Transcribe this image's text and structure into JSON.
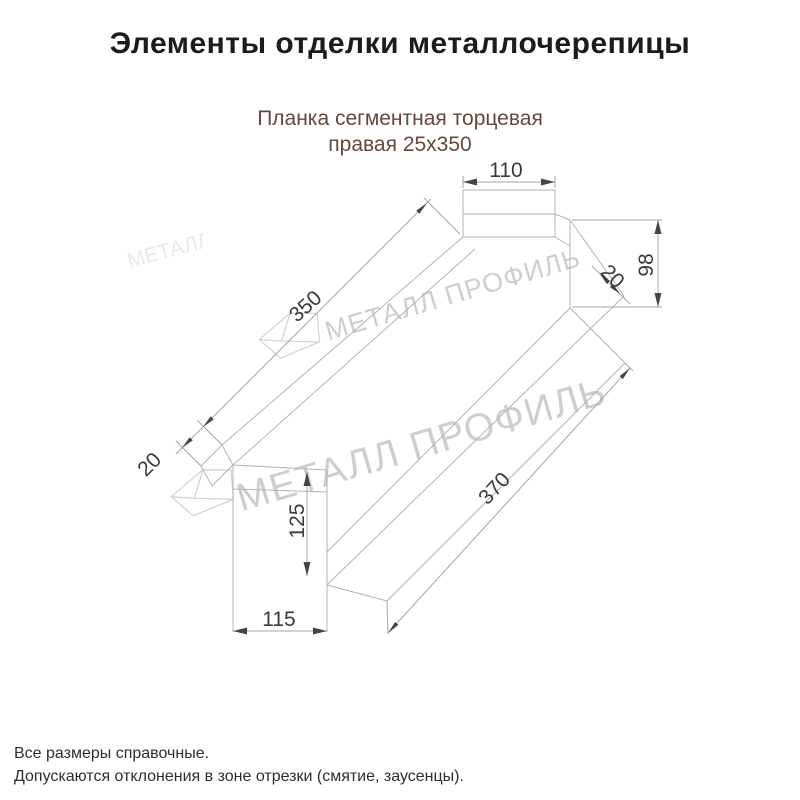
{
  "page": {
    "title": "Элементы отделки металлочерепицы"
  },
  "product": {
    "name_line1": "Планка сегментная торцевая",
    "name_line2": "правая 25х350"
  },
  "drawing": {
    "dims": {
      "tab_width": "110",
      "length_top": "350",
      "end_fold_left": "20",
      "right_height": "98",
      "right_fold": "20",
      "length_bottom": "370",
      "bottom_tab_height": "125",
      "bottom_tab_width": "115"
    }
  },
  "watermark": {
    "text": "МЕТАЛЛ ПРОФИЛЬ"
  },
  "notes": {
    "line1": "Все размеры справочные.",
    "line2": "Допускаются отклонения в зоне отрезки (смятие, заусенцы)."
  },
  "colors": {
    "subtitle": "#67463c",
    "shape_line": "#b3b3b3",
    "dim_line": "#a6a6a6",
    "dim_text": "#3a3a3a",
    "watermark": "#cecece"
  }
}
